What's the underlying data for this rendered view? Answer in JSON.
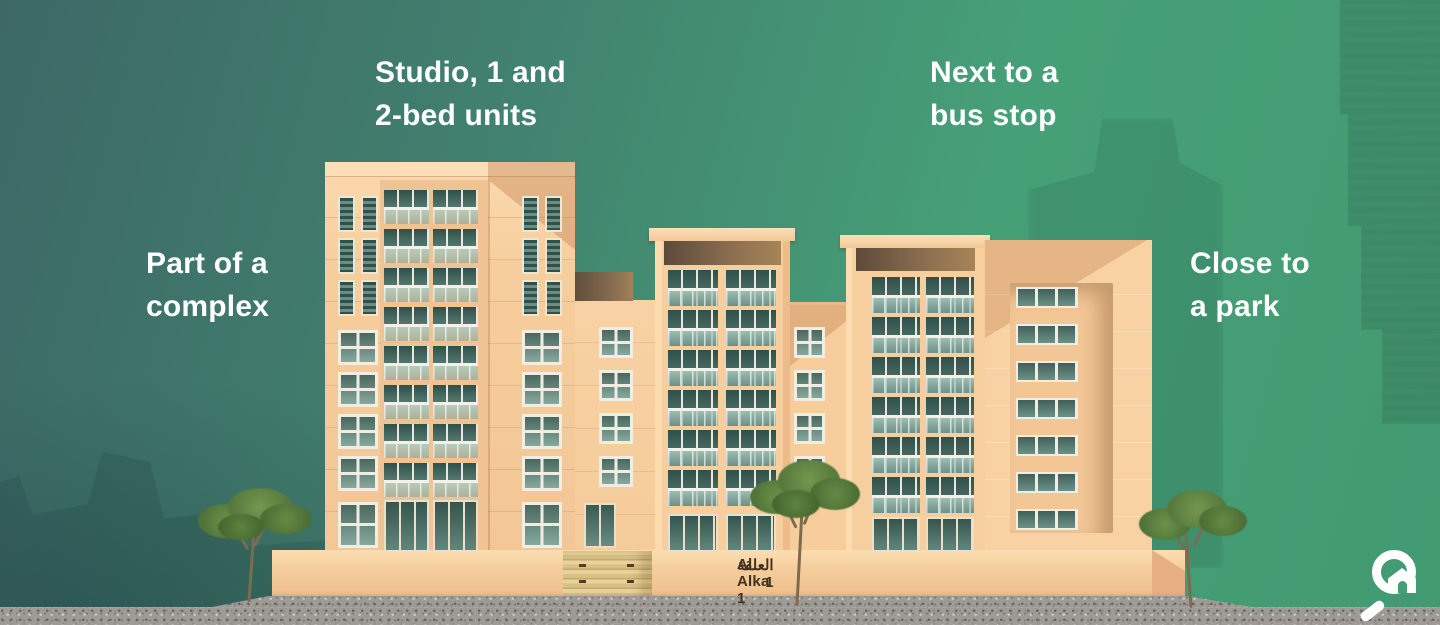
{
  "labels": {
    "units": "Studio, 1 and\n2-bed units",
    "bus_stop": "Next to a\nbus stop",
    "complex": "Part of a\ncomplex",
    "park": "Close to\na park"
  },
  "building": {
    "name_en": "Al Alka 1",
    "name_ar": "العلقة 1"
  },
  "logo": {
    "icon": "magnifier-house-icon"
  },
  "colors": {
    "background_teal": "#3d6866",
    "background_green": "#46a077",
    "facade_cream": "#f8d2a2",
    "facade_shadow": "#e2ad80",
    "window_glass": "#33524c",
    "label_text": "#ffffff",
    "name_text": "#42321d",
    "logo_white": "#ffffff"
  }
}
